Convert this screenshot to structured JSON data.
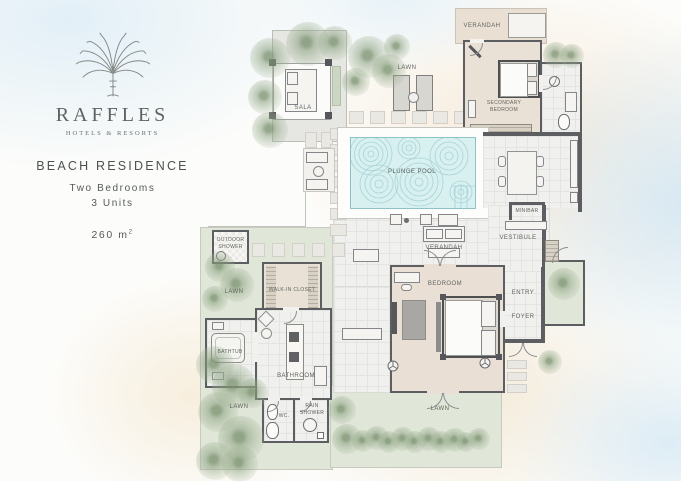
{
  "brand": {
    "name": "RAFFLES",
    "tagline": "HOTELS & RESORTS"
  },
  "residence": {
    "title": "BEACH RESIDENCE",
    "bedrooms": "Two Bedrooms",
    "units": "3 Units",
    "area": "260 m",
    "area_sup": "2"
  },
  "plan": {
    "labels": {
      "sala": "SALA",
      "lawn_top": "LAWN",
      "verandah_top": "VERANDAH",
      "secondary_bedroom": "SECONDARY BEDROOM",
      "plunge_pool": "PLUNGE POOL",
      "verandah_living": "VERANDAH",
      "minibar": "MINIBAR",
      "vestibule": "VESTIBULE",
      "bedroom": "BEDROOM",
      "entry": "ENTRY",
      "foyer": "FOYER",
      "outdoor_shower": "OUTDOOR SHOWER",
      "lawn_left": "LAWN",
      "walk_in_closet": "WALK-IN CLOSET",
      "bathtub": "BATHTUB",
      "bathroom": "BATHROOM",
      "wc": "WC.",
      "rain_shower": "RAIN SHOWER",
      "lawn_bottom_left": "LAWN",
      "lawn_bottom": "LAWN"
    }
  },
  "colors": {
    "wall": "#5c5e61",
    "floor_beige": "#eae1d6",
    "tile": "#f0f0ee",
    "lawn": "#e0e6d8",
    "pool_water": "#d8f0f0",
    "pool_lines": "#a8d4d6",
    "sand": "#f6e7d4",
    "sky": "#e2eff7",
    "text": "#4b5350"
  }
}
